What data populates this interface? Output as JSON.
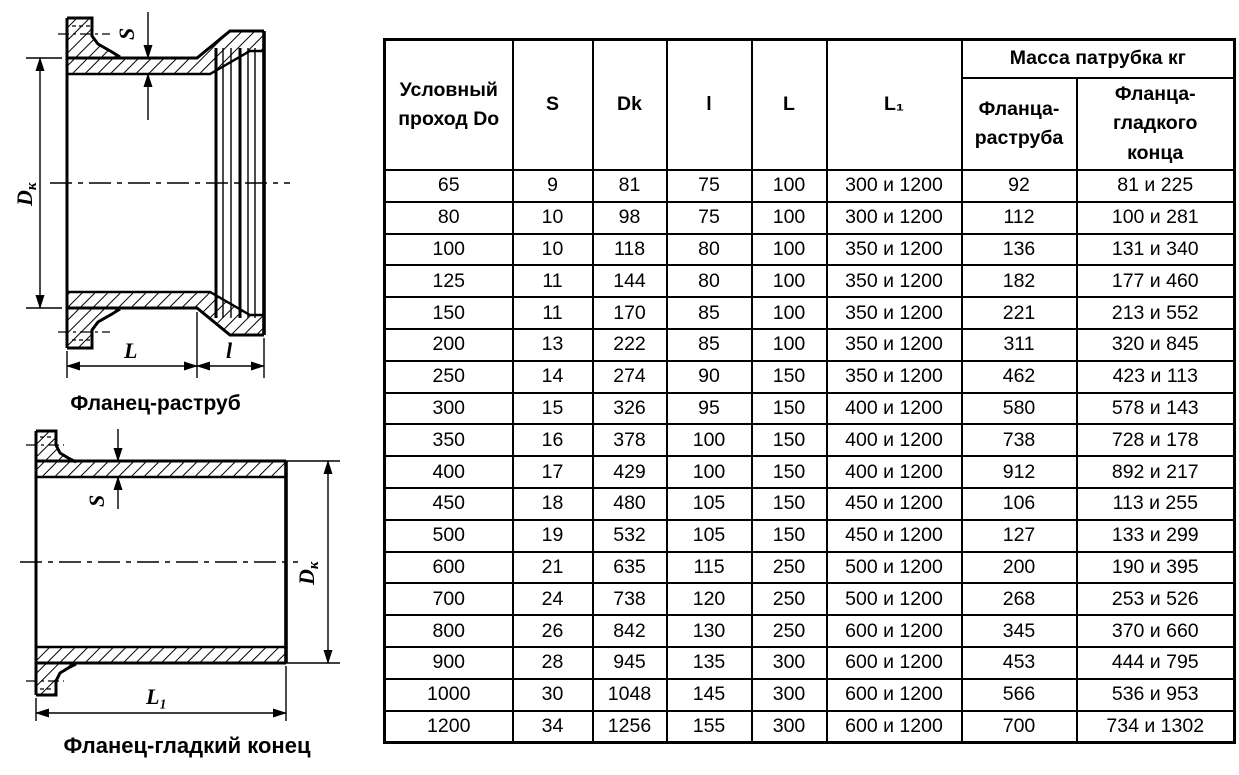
{
  "colors": {
    "ink": "#000000",
    "background": "#ffffff"
  },
  "drawings": {
    "top": {
      "caption": "Фланец-раструб",
      "labels": {
        "s": "S",
        "dk_main": "D",
        "dk_sub": "к",
        "L": "L",
        "l": "l"
      }
    },
    "bottom": {
      "caption": "Фланец-гладкий конец",
      "labels": {
        "s": "S",
        "dk_main": "D",
        "dk_sub": "к",
        "L1": "L₁"
      }
    }
  },
  "table": {
    "col_headers": {
      "do": "Условный\nпроход Do",
      "s": "S",
      "dk": "Dk",
      "l": "l",
      "L": "L",
      "L1": "L₁",
      "mass_group": "Масса патрубка кг",
      "mass_socket": "Фланца-\nраструба",
      "mass_plain": "Фланца-\nгладкого\nконца"
    },
    "rows": [
      [
        "65",
        "9",
        "81",
        "75",
        "100",
        "300 и 1200",
        "92",
        "81 и 225"
      ],
      [
        "80",
        "10",
        "98",
        "75",
        "100",
        "300 и 1200",
        "112",
        "100 и 281"
      ],
      [
        "100",
        "10",
        "118",
        "80",
        "100",
        "350 и 1200",
        "136",
        "131 и 340"
      ],
      [
        "125",
        "11",
        "144",
        "80",
        "100",
        "350 и 1200",
        "182",
        "177 и 460"
      ],
      [
        "150",
        "11",
        "170",
        "85",
        "100",
        "350 и 1200",
        "221",
        "213 и 552"
      ],
      [
        "200",
        "13",
        "222",
        "85",
        "100",
        "350 и 1200",
        "311",
        "320 и 845"
      ],
      [
        "250",
        "14",
        "274",
        "90",
        "150",
        "350 и 1200",
        "462",
        "423 и 113"
      ],
      [
        "300",
        "15",
        "326",
        "95",
        "150",
        "400 и 1200",
        "580",
        "578 и 143"
      ],
      [
        "350",
        "16",
        "378",
        "100",
        "150",
        "400 и 1200",
        "738",
        "728 и 178"
      ],
      [
        "400",
        "17",
        "429",
        "100",
        "150",
        "400 и 1200",
        "912",
        "892 и 217"
      ],
      [
        "450",
        "18",
        "480",
        "105",
        "150",
        "450 и 1200",
        "106",
        "113 и 255"
      ],
      [
        "500",
        "19",
        "532",
        "105",
        "150",
        "450 и 1200",
        "127",
        "133 и 299"
      ],
      [
        "600",
        "21",
        "635",
        "115",
        "250",
        "500 и 1200",
        "200",
        "190 и 395"
      ],
      [
        "700",
        "24",
        "738",
        "120",
        "250",
        "500 и 1200",
        "268",
        "253 и 526"
      ],
      [
        "800",
        "26",
        "842",
        "130",
        "250",
        "600 и 1200",
        "345",
        "370 и 660"
      ],
      [
        "900",
        "28",
        "945",
        "135",
        "300",
        "600 и 1200",
        "453",
        "444 и 795"
      ],
      [
        "1000",
        "30",
        "1048",
        "145",
        "300",
        "600 и 1200",
        "566",
        "536 и 953"
      ],
      [
        "1200",
        "34",
        "1256",
        "155",
        "300",
        "600 и 1200",
        "700",
        "734 и 1302"
      ]
    ]
  }
}
